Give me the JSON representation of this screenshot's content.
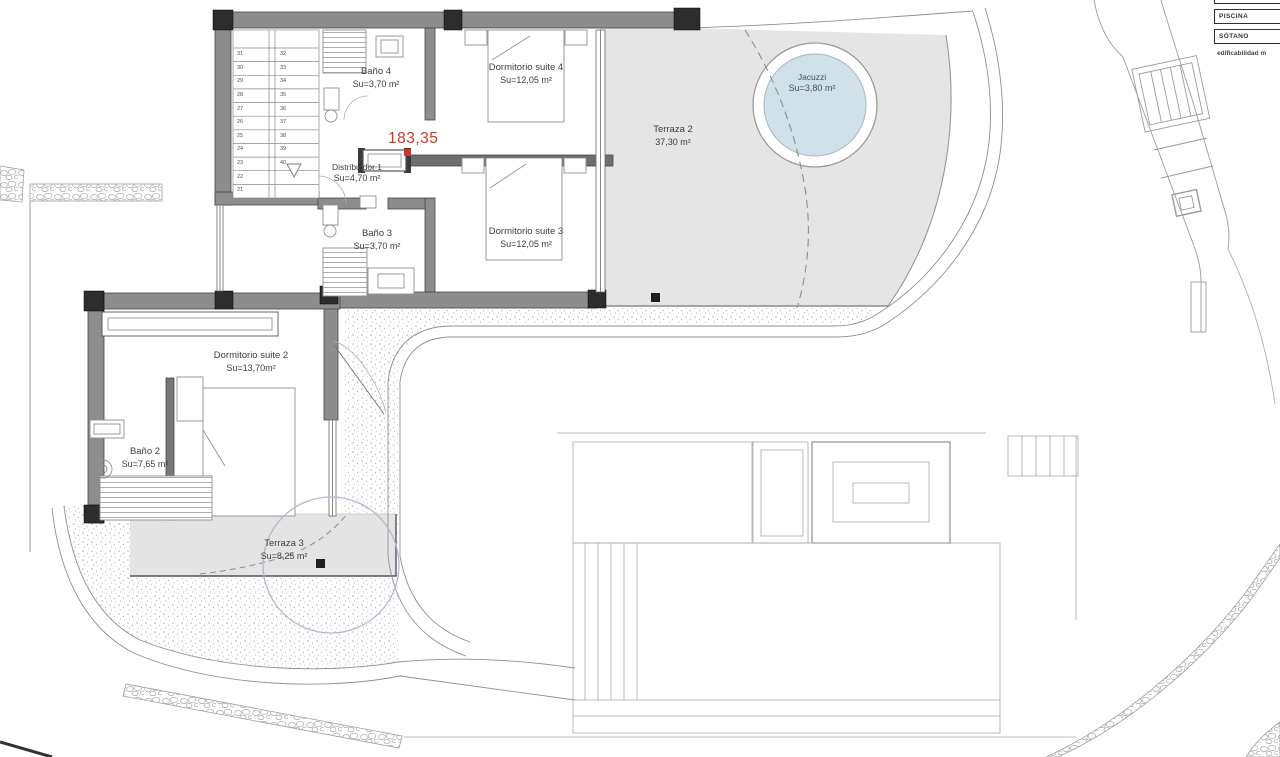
{
  "legend": {
    "box_top": "",
    "boxes": [
      "PISCINA",
      "SÓTANO"
    ],
    "note": "edificabilidad m"
  },
  "measurement_label": "183,35",
  "rooms": {
    "bano4": {
      "name": "Baño 4",
      "area": "Su=3,70 m²"
    },
    "dorm4": {
      "name": "Dormitorio suite 4",
      "area": "Su=12,05 m²"
    },
    "terraza2": {
      "name": "Terraza 2",
      "area": "37,30 m²"
    },
    "jacuzzi": {
      "name": "Jacuzzi",
      "area": "Su=3,80 m²"
    },
    "distribuidor1": {
      "name": "Distribuidor 1",
      "area": "Su=4,70 m²"
    },
    "bano3": {
      "name": "Baño 3",
      "area": "Su=3,70 m²"
    },
    "dorm3": {
      "name": "Dormitorio suite 3",
      "area": "Su=12,05 m²"
    },
    "dorm2": {
      "name": "Dormitorio suite 2",
      "area": "Su=13,70m²"
    },
    "bano2": {
      "name": "Baño 2",
      "area": "Su=7,65 m²"
    },
    "terraza3": {
      "name": "Terraza 3",
      "area": "Su=8,25 m²"
    }
  },
  "stairs": {
    "left_numbers": [
      "31",
      "30",
      "29",
      "28",
      "27",
      "26",
      "25",
      "24",
      "23",
      "22",
      "21"
    ],
    "right_numbers": [
      "32",
      "33",
      "34",
      "35",
      "36",
      "37",
      "38",
      "39",
      "40"
    ]
  },
  "colors": {
    "accent_red": "#d43425",
    "terrace_fill": "#e5e5e5",
    "jacuzzi_water": "#cfe0e8",
    "wall_gray": "#8d8d8d",
    "pillar_dark": "#2d2d2d",
    "tree_circle": "#b6b5cd"
  }
}
